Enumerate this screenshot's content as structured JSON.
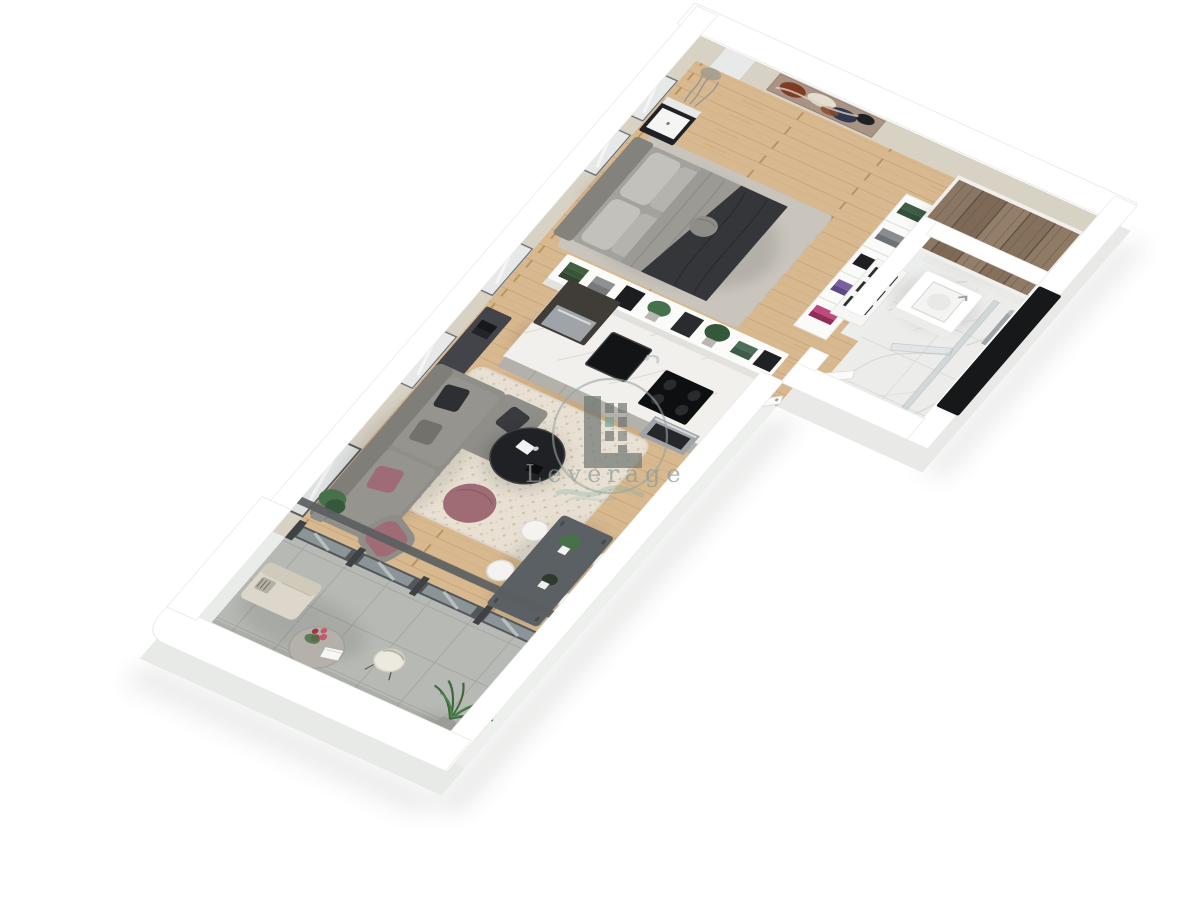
{
  "watermark": {
    "brand": "Leverage",
    "color": "#8f9a95",
    "circle_color": "#9aa5a0",
    "mark_color": "#6d7470",
    "accent_teal": "#6fa8a0"
  },
  "palette": {
    "wall_top": "#ffffff",
    "wall_face": "#d8d2c5",
    "wall_face_light": "#e9eae7",
    "wood": "#d8b88f",
    "wood_line": "#c29a6f",
    "tile": "#b7b9b4",
    "tile_line": "#a4a6a1",
    "marble": "#ececea",
    "rug": "#e8e1d3",
    "rug_dot": "#d4c8b4",
    "sofa": "#8f8e89",
    "sofa_back": "#7f7e78",
    "mauve": "#9f6b75",
    "cushion_dark": "#2e2f33",
    "table_dark": "#5b6064",
    "coffee_black": "#202125",
    "wardrobe": "#8a7461",
    "wardrobe_grain": "#6e5b49",
    "console_dark": "#434449",
    "glass": "#b9c6c8",
    "frame_dark": "#53575a",
    "plant": "#47714a",
    "plant_dark": "#35573a",
    "bed_duvet": "#9b9a94",
    "bed_throw": "#35363a",
    "black_panel": "#17181a",
    "steel": "#9ea4a7",
    "art_rust": "#7d3b24",
    "art_navy": "#303850",
    "art_base": "#a89384"
  },
  "scene": {
    "type": "3d-floor-plan",
    "rooms": [
      {
        "name": "bedroom",
        "furniture": "bed, nightstand, wall art, clothes shelf, bookcase"
      },
      {
        "name": "kitchen",
        "furniture": "island with sink and cooktop, oven, console table"
      },
      {
        "name": "living-dining",
        "furniture": "sofa, coffee table, pouf, armchair, rug, dining table, chairs"
      },
      {
        "name": "hallway",
        "furniture": "wardrobe, shoe cabinet, open door"
      },
      {
        "name": "bathroom",
        "furniture": "vanity, walk-in shower, glass screens"
      },
      {
        "name": "balcony",
        "furniture": "loveseat, bistro table, chair, palm plant"
      }
    ]
  }
}
